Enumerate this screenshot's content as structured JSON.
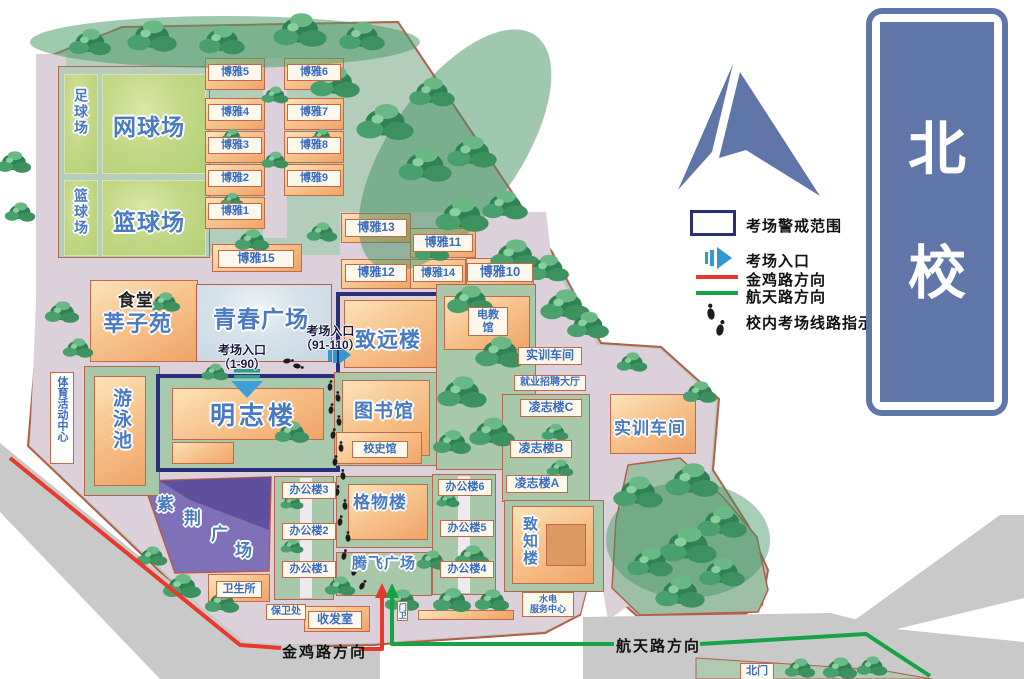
{
  "badge": {
    "char1": "北",
    "char2": "校"
  },
  "legend": {
    "alert": "考场警戒范围",
    "entrance": "考场入口",
    "jinji": "金鸡路方向",
    "hangtian": "航天路方向",
    "route": "校内考场线路指示"
  },
  "roads": {
    "jinji": "金鸡路方向",
    "hangtian": "航天路方向"
  },
  "entrance1": {
    "t": "考场入口",
    "r": "（1-90）"
  },
  "entrance2": {
    "t": "考场入口",
    "r": "（91-110）"
  },
  "sports": {
    "football": "足球场",
    "basket_small": "篮球场",
    "tennis": "网球场",
    "basketball": "篮球场"
  },
  "plaza": {
    "qingchun": "青春广场",
    "tengfei": "腾飞广场",
    "z1": "紫",
    "z2": "荆",
    "z3": "广",
    "z4": "场"
  },
  "bld": {
    "canteen": "食堂",
    "xinzi": "莘子苑",
    "mingzhi": "明志楼",
    "zhiyuan": "致远楼",
    "library": "图书馆",
    "xiaoshi": "校史馆",
    "dianjiao": "电教馆",
    "gewu": "格物楼",
    "zhizhi": "致知楼",
    "shixun_s": "实训车间",
    "jiuye": "就业招聘大厅",
    "shixun_b": "实训车间",
    "swim": "游泳池",
    "tiyu": "体育活动中心",
    "weisheng": "卫生所",
    "baowei": "保卫处",
    "shoufa": "收发室",
    "shuidian1": "水电",
    "shuidian2": "服务中心",
    "beimen": "北门",
    "menwei": "门卫"
  },
  "boya": {
    "b1": "博雅1",
    "b2": "博雅2",
    "b3": "博雅3",
    "b4": "博雅4",
    "b5": "博雅5",
    "b6": "博雅6",
    "b7": "博雅7",
    "b8": "博雅8",
    "b9": "博雅9",
    "b10": "博雅10",
    "b11": "博雅11",
    "b12": "博雅12",
    "b13": "博雅13",
    "b14": "博雅14",
    "b15": "博雅15"
  },
  "office": {
    "o1": "办公楼1",
    "o2": "办公楼2",
    "o3": "办公楼3",
    "o4": "办公楼4",
    "o5": "办公楼5",
    "o6": "办公楼6"
  },
  "lingzhi": {
    "a": "凌志楼A",
    "b": "凌志楼B",
    "c": "凌志楼C"
  },
  "colors": {
    "jinji_red": "#e8392c",
    "hangtian_green": "#17a344",
    "navy_box": "#2b2e78",
    "badge_blue": "#6075a8",
    "entrance_blue": "#2f9ad2"
  }
}
